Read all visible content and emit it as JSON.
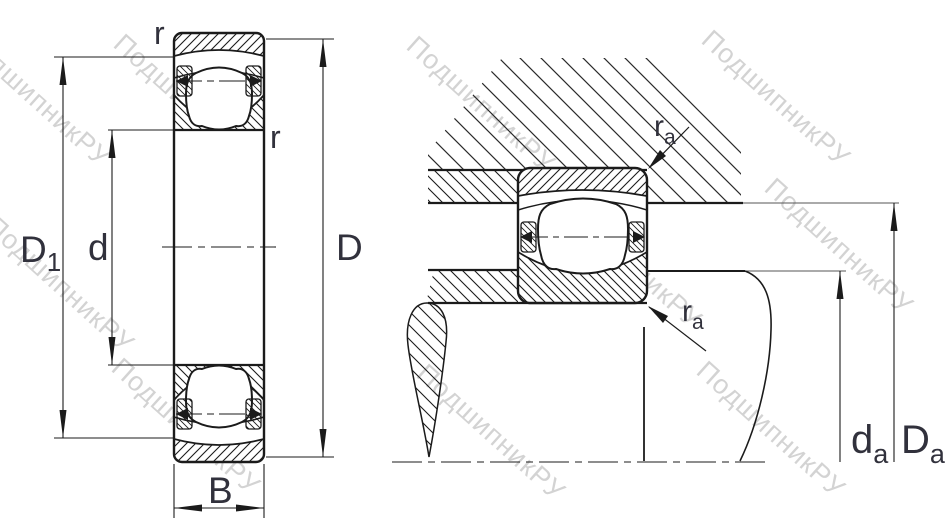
{
  "labels": {
    "r_outer": "r",
    "r_inner": "r",
    "d1": {
      "base": "D",
      "sub": "1"
    },
    "d": "d",
    "D": "D",
    "B": "B",
    "ra_top": {
      "base": "r",
      "sub": "a"
    },
    "ra_bottom": {
      "base": "r",
      "sub": "a"
    },
    "da": {
      "base": "d",
      "sub": "a"
    },
    "Da": {
      "base": "D",
      "sub": "a"
    }
  },
  "watermark": {
    "text": "ПодшипникРУ",
    "color": "#c8c8c8"
  },
  "colors": {
    "line": "#1b1b1b",
    "label": "#31313c",
    "background": "#ffffff"
  }
}
